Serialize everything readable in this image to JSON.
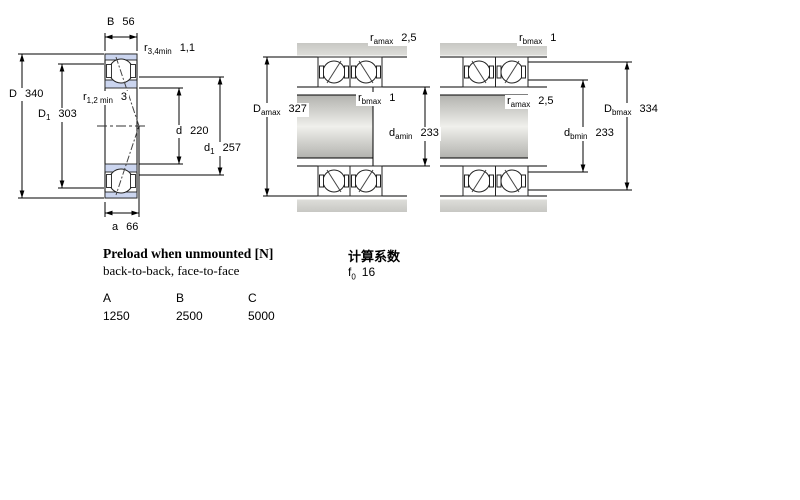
{
  "drawing": {
    "single_bearing": {
      "description": "angular contact ball bearing cross-section",
      "labels": {
        "B": {
          "main": "B",
          "sub": "",
          "value": "56"
        },
        "r34min": {
          "main": "r",
          "sub": "3,4min",
          "value": "1,1"
        },
        "D": {
          "main": "D",
          "sub": "",
          "value": "340"
        },
        "D1": {
          "main": "D",
          "sub": "1",
          "value": "303"
        },
        "r12min": {
          "main": "r",
          "sub": "1,2 min",
          "value": "3"
        },
        "d": {
          "main": "d",
          "sub": "",
          "value": "220"
        },
        "d1": {
          "main": "d",
          "sub": "1",
          "value": "257"
        },
        "a": {
          "main": "a",
          "sub": "",
          "value": "66"
        }
      }
    },
    "arrangement_back_to_back": {
      "labels": {
        "r_amax_top": {
          "main": "r",
          "sub": "amax",
          "value": "2,5"
        },
        "r_bmax": {
          "main": "r",
          "sub": "bmax",
          "value": "1"
        },
        "D_amax": {
          "main": "D",
          "sub": "amax",
          "value": "327"
        },
        "d_amin": {
          "main": "d",
          "sub": "amin",
          "value": "233"
        }
      }
    },
    "arrangement_face_to_face": {
      "labels": {
        "r_bmax_top": {
          "main": "r",
          "sub": "bmax",
          "value": "1"
        },
        "r_amax": {
          "main": "r",
          "sub": "amax",
          "value": "2,5"
        },
        "D_bmax": {
          "main": "D",
          "sub": "bmax",
          "value": "334"
        },
        "d_bmin": {
          "main": "d",
          "sub": "bmin",
          "value": "233"
        }
      }
    },
    "colors": {
      "ring_fill": "#cbd5ef",
      "steel_gray": "#c6c6c2",
      "line": "#000000"
    }
  },
  "preload": {
    "title": "Preload when unmounted [N]",
    "subtitle": "back-to-back, face-to-face",
    "table": {
      "headers": [
        "A",
        "B",
        "C"
      ],
      "values": [
        "1250",
        "2500",
        "5000"
      ]
    }
  },
  "factors": {
    "title": "计算系数",
    "f0": {
      "main": "f",
      "sub": "0",
      "value": "16"
    }
  }
}
